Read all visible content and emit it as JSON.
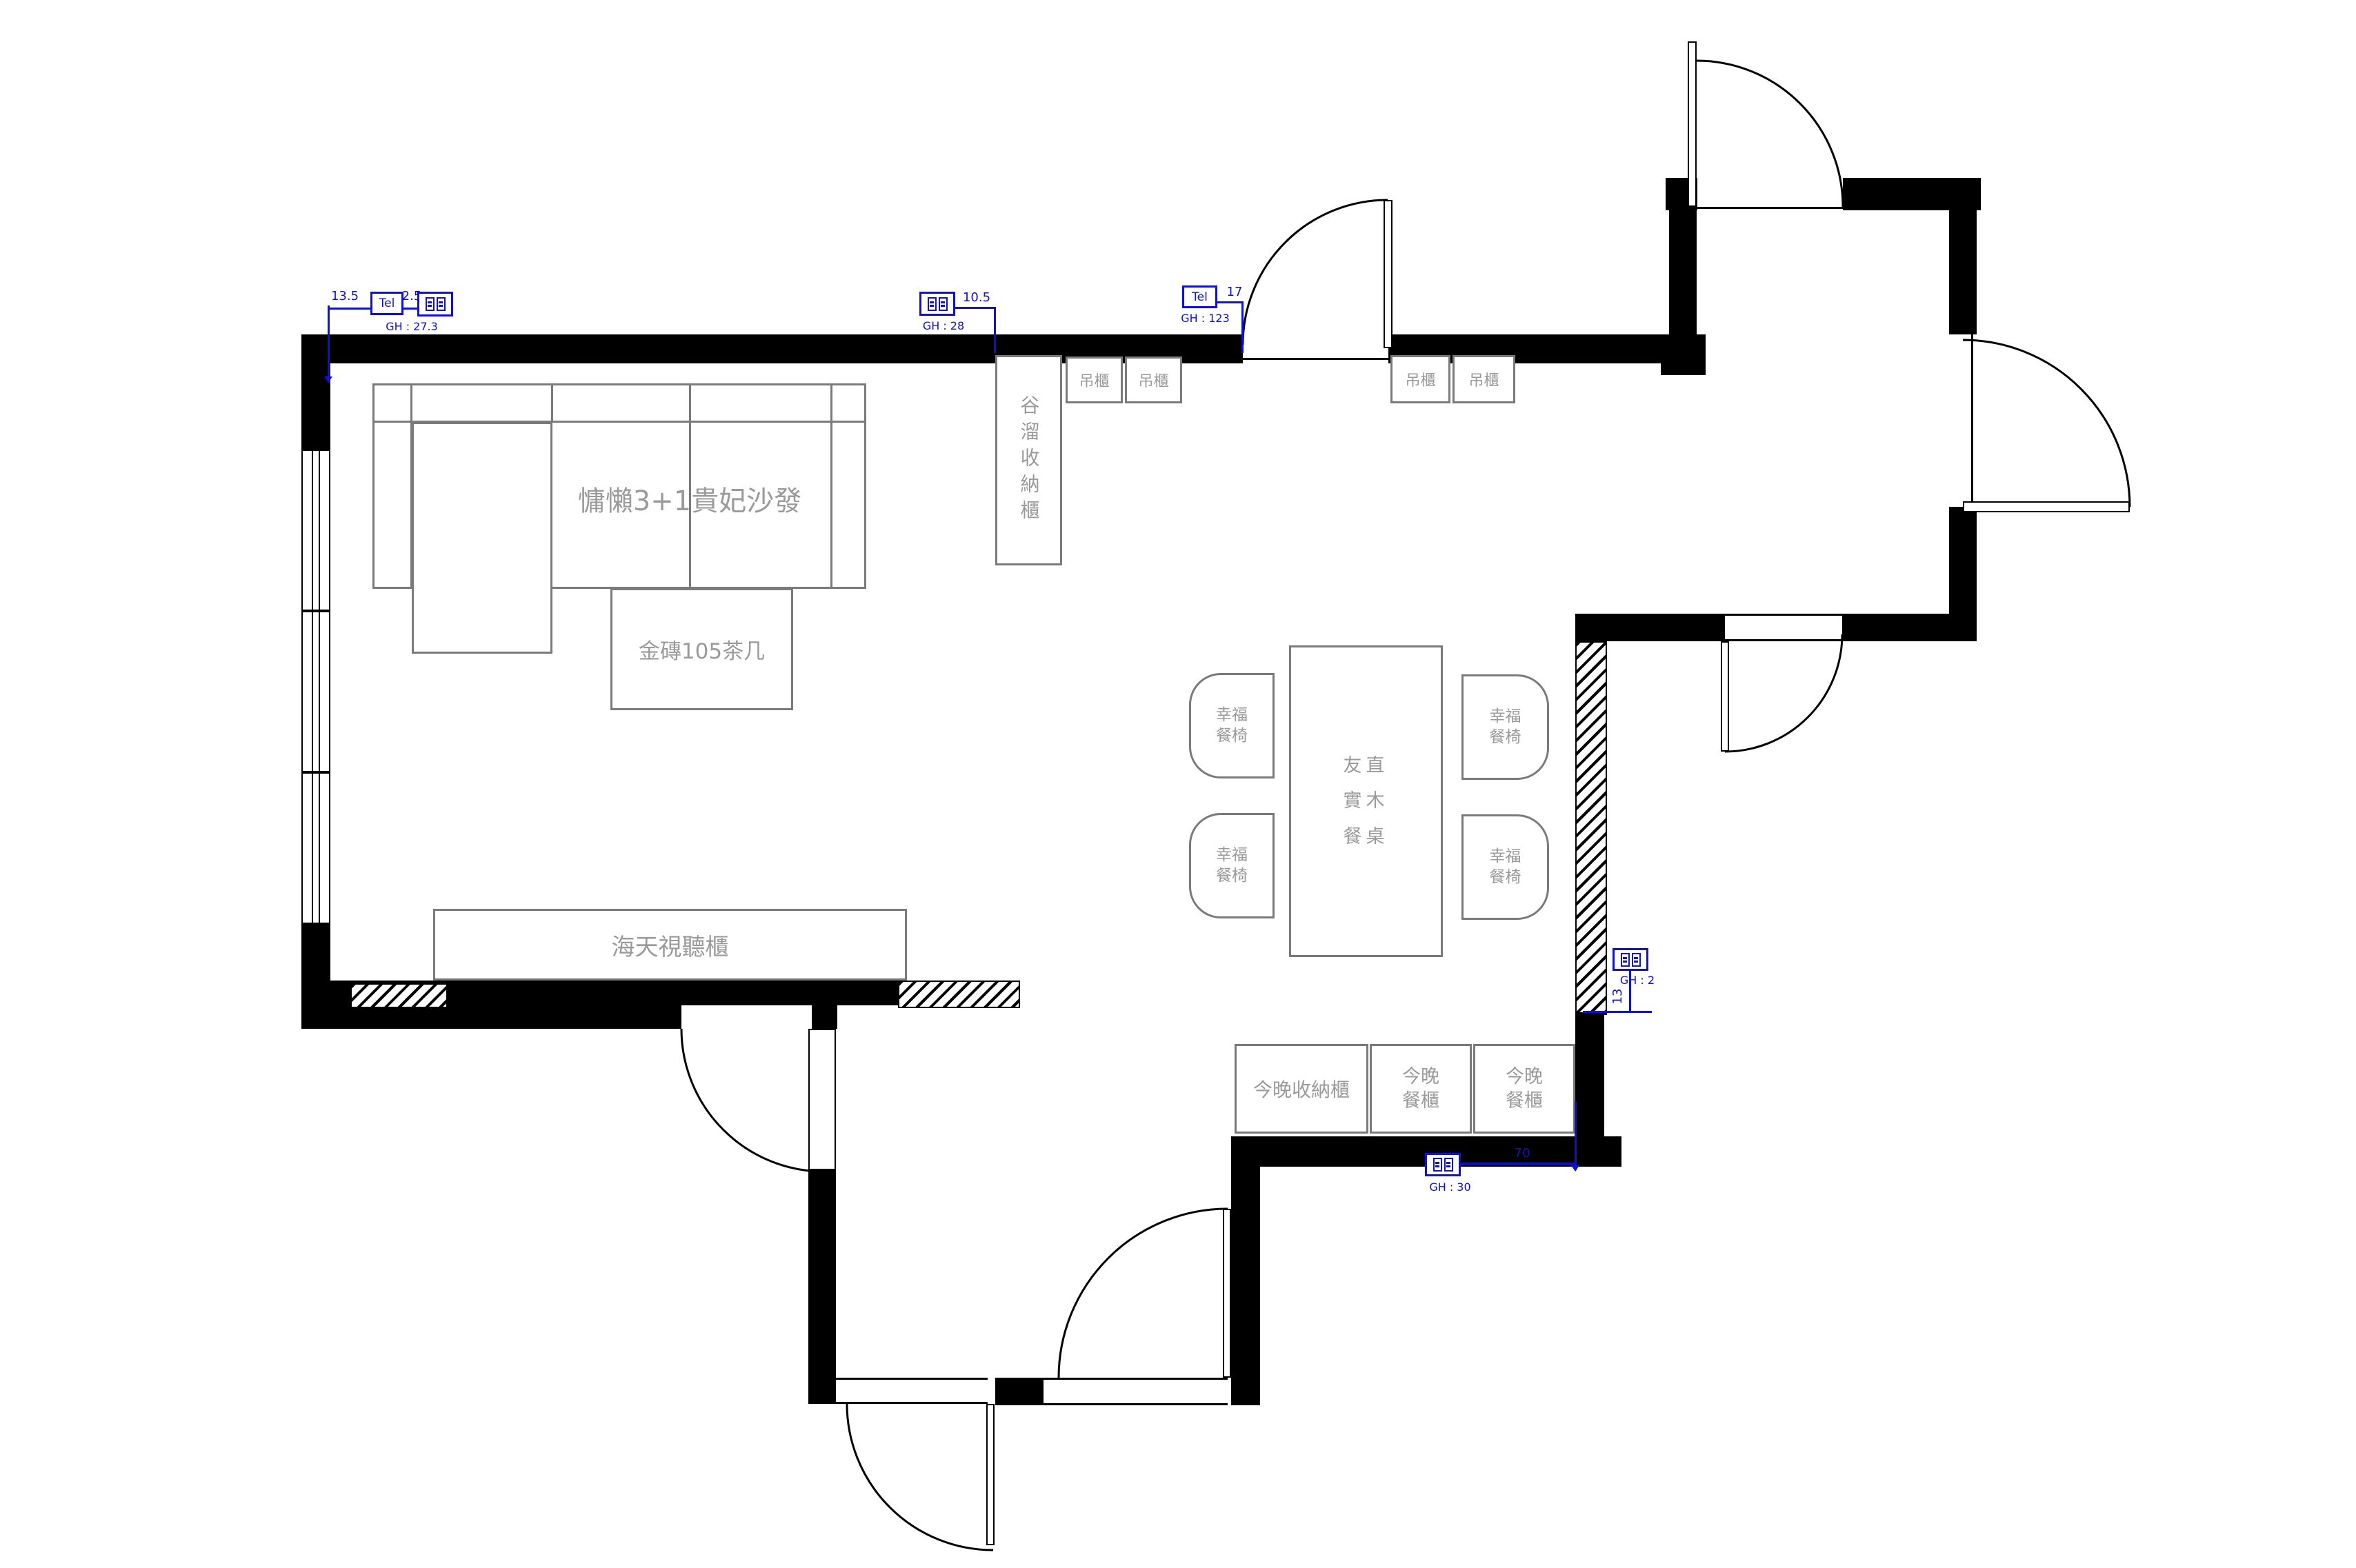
{
  "colors": {
    "wall": "#000000",
    "furniture_line": "#7a7a7a",
    "furniture_text": "#9a9a9a",
    "annotation_blue": "#1010d0"
  },
  "furniture": {
    "sofa": {
      "label": "慵懶3+1貴妃沙發"
    },
    "coffee_table": {
      "label": "金磚105茶几"
    },
    "tv_cabinet": {
      "label": "海天視聽櫃"
    },
    "tall_cabinet": {
      "label": "谷溜收納櫃"
    },
    "hanging_cabinets": [
      "吊櫃",
      "吊櫃",
      "吊櫃",
      "吊櫃"
    ],
    "dining_table": {
      "lines": [
        "友直",
        "實木",
        "餐桌"
      ]
    },
    "dining_chair": {
      "lines": [
        "幸福",
        "餐椅"
      ]
    },
    "storage_cabinet": {
      "label": "今晚收納櫃"
    },
    "sideboard": {
      "lines": [
        "今晚",
        "餐櫃"
      ]
    }
  },
  "annotations": {
    "a1": {
      "dim_left": "13.5",
      "tel": "Tel",
      "dim_right": "2.5",
      "gh": "GH : 27.3"
    },
    "a2": {
      "dim": "10.5",
      "gh": "GH : 28"
    },
    "a3": {
      "tel": "Tel",
      "dim": "17",
      "gh": "GH : 123"
    },
    "a4": {
      "gh": "GH : 2",
      "dim": "13"
    },
    "a5": {
      "dim": "70",
      "gh": "GH : 30"
    }
  }
}
